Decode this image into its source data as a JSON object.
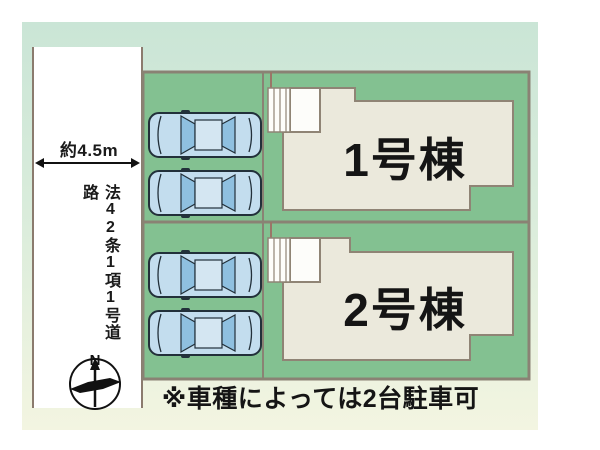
{
  "road": {
    "width_label": "約4.5m",
    "name": "法42条1項1号道路"
  },
  "plots": [
    {
      "label": "1号棟"
    },
    {
      "label": "2号棟"
    }
  ],
  "note": "※車種によっては2台駐車可",
  "compass": {
    "north_label": "N"
  },
  "icons": {
    "car": "car-top-view-icon",
    "compass": "north-arrow-compass-icon",
    "dimension_arrow": "double-headed-arrow-icon"
  },
  "colors": {
    "background_panel_top": "#cae5d6",
    "background_panel_bottom": "#f3f5e1",
    "lot_green": "#83c191",
    "lot_border": "#8a8274",
    "building_fill": "#ebe9dc",
    "building_border": "#8f8475",
    "road_fill": "#ffffff",
    "road_border": "#8b7b6e",
    "car_body": "#c3ddee",
    "car_glass": "#8fc0e0",
    "text": "#1a1a1a"
  }
}
